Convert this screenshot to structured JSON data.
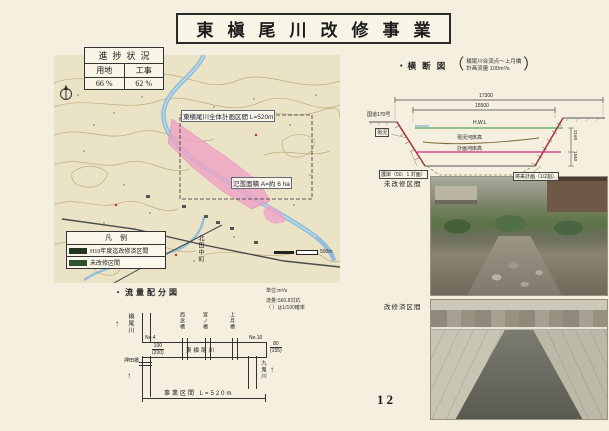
{
  "page": {
    "number": "12",
    "background": "#f4efde"
  },
  "title": {
    "text": "東槇尾川改修事業"
  },
  "progress": {
    "title": "進捗状況",
    "columns": [
      "用地",
      "工事"
    ],
    "values": [
      "66 %",
      "62 %"
    ]
  },
  "map": {
    "plan_label": "東槇尾川全体計画区間 L=520m",
    "flood_label": "氾濫面積 A=約 6 ha",
    "town_label": "北田中町",
    "scale_label": "500m",
    "legend": {
      "title": "凡例",
      "items": [
        {
          "label": "H10年度迄改修済区間",
          "color": "#22341f"
        },
        {
          "label": "未改修区間",
          "color": "#2f4f2f"
        }
      ]
    },
    "colors": {
      "river": "#86b8d8",
      "flood_area": "#efa3c5",
      "base": "#ebe3c6"
    }
  },
  "cross_section": {
    "heading": "・横 断 図",
    "bracket_open": "（",
    "bracket_close": "）",
    "note_line1": "槇尾川合流点～上月橋",
    "note_line2": "計画流量 100m³/s",
    "dim_top": "17300",
    "dim_inner": "15500",
    "dim_right_upper": "2160",
    "dim_right_lower": "1940",
    "label_road": "国道170号",
    "label_current": "現況",
    "label_hwl": "H.W.L",
    "label_bed_current": "現況河床高",
    "label_bed_plan": "計画河床高",
    "label_revet": "護岸（50：1 対面）",
    "label_future": "将来計画（1/2割）",
    "colors": {
      "hwl": "#2f8f3f",
      "plan_bed": "#cc2a7a",
      "revetment": "#b03048"
    }
  },
  "photos": [
    {
      "label": "未改修区間"
    },
    {
      "label": "改修済区間"
    }
  ],
  "flow": {
    "heading": "・流量配分図",
    "unit_note": "単位:m³/s",
    "flow_note": "流量:S60.8対応",
    "prob_note": "（ ）は1/100確率",
    "river_left": "槇尾川",
    "river_right": "九鬼川",
    "channel": "東槇尾川",
    "station_left": "No.4",
    "station_right": "No.10",
    "values_left": [
      "100",
      "(200)"
    ],
    "values_right": [
      "80",
      "(155)"
    ],
    "bridges": [
      "西念橋",
      "宮ノ橋",
      "上月橋"
    ],
    "bridge_bottom": "押田橋",
    "span_label": "事業区間 L=520m",
    "arrow_up": "↑"
  }
}
